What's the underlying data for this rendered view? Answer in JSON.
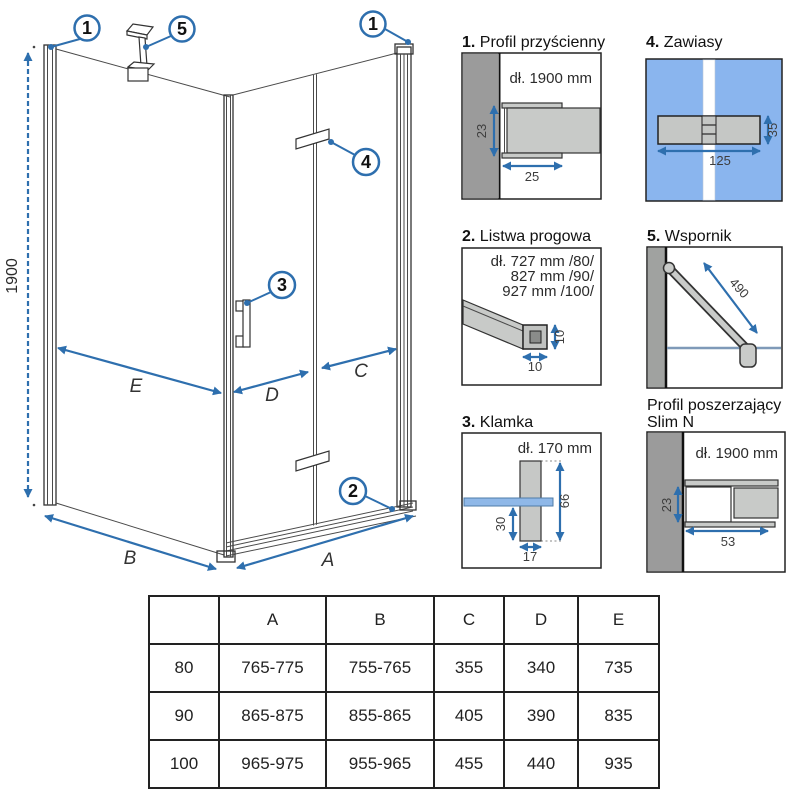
{
  "colors": {
    "accent_blue": "#2e6fae",
    "glass_blue": "#8ab5ee",
    "handle_glass_blue": "#8fb8e8",
    "wall_gray": "#9b9b9b",
    "profile_gray": "#c8cac8",
    "line_dark": "#3c3c3c"
  },
  "main": {
    "height_dim": "1900",
    "dim_a": "A",
    "dim_b": "B",
    "dim_c": "C",
    "dim_d": "D",
    "dim_e": "E",
    "callouts": {
      "wall_profile": "1",
      "threshold": "2",
      "handle": "3",
      "hinge": "4",
      "support": "5"
    }
  },
  "panels": [
    {
      "num": "1.",
      "name": "Profil przyścienny",
      "length": "dł. 1900 mm",
      "dim_height": "23",
      "dim_depth": "25"
    },
    {
      "num": "4.",
      "name": "Zawiasy",
      "dim_width": "125",
      "dim_height": "35"
    },
    {
      "num": "2.",
      "name": "Listwa progowa",
      "length_lines": [
        "dł. 727 mm /80/",
        "827 mm /90/",
        "927 mm /100/"
      ],
      "dim_width": "10",
      "dim_height": "10"
    },
    {
      "num": "5.",
      "name": "Wspornik",
      "dim_length": "490"
    },
    {
      "num": "3.",
      "name": "Klamka",
      "length": "dł. 170 mm",
      "dim_lower": "30",
      "dim_width": "17",
      "dim_height": "66"
    },
    {
      "num": "",
      "name": "Profil poszerzający",
      "name2": "Slim N",
      "length": "dł. 1900 mm",
      "dim_height": "23",
      "dim_width": "53"
    }
  ],
  "table": {
    "headers": [
      "",
      "A",
      "B",
      "C",
      "D",
      "E"
    ],
    "rows": [
      [
        "80",
        "765-775",
        "755-765",
        "355",
        "340",
        "735"
      ],
      [
        "90",
        "865-875",
        "855-865",
        "405",
        "390",
        "835"
      ],
      [
        "100",
        "965-975",
        "955-965",
        "455",
        "440",
        "935"
      ]
    ]
  }
}
